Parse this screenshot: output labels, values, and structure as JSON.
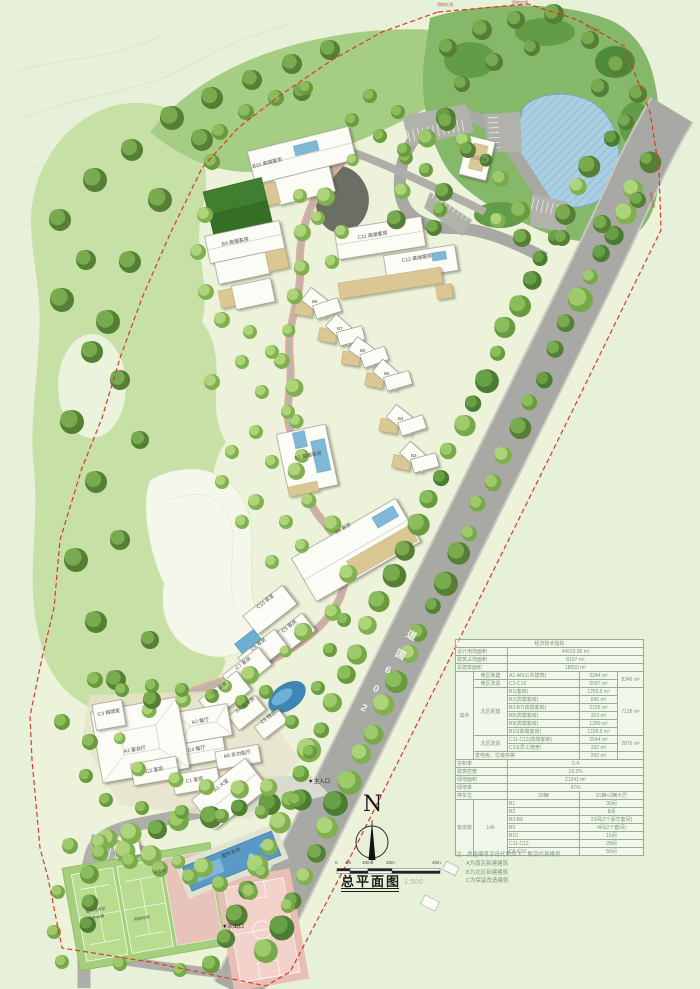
{
  "title": {
    "text": "总平面图",
    "scale": "1:500"
  },
  "compass": {
    "n": "N"
  },
  "scalebar": {
    "t0": "0",
    "t1": "4m",
    "t2": "10m",
    "t3": "20m",
    "t4": "40m"
  },
  "road": {
    "name": "206国道",
    "chars": [
      "2",
      "0",
      "6",
      "国",
      "道"
    ]
  },
  "palette": {
    "boundary_red": "#da392b",
    "water_blue": "#aacfe2",
    "road_gray": "#a8a8a4",
    "tree_green": "#77a84a",
    "building_white": "#fcfcf6",
    "terrace_tan": "#dbc794"
  },
  "labels": {
    "b10": "B10 高端客房",
    "b9": "B9 高端客房",
    "c11": "C11 高端客房",
    "c12": "C12 高端客房",
    "b8": "B8",
    "b7": "B7",
    "b6": "B6",
    "b5": "B5",
    "b4": "B4",
    "b3": "B3",
    "b2": "B2 高端客房",
    "b1": "B1 客房",
    "c10": "C10 茶室",
    "c9": "C9 客房",
    "c8": "C8 客房",
    "c7": "C7 客房",
    "c6": "C6 客房",
    "c5": "C5 精品店",
    "a4": "A4 健身房",
    "a3": "A3 餐厅",
    "c4": "C4 餐厅",
    "a2": "A2 宴会厅",
    "a6": "A6 多功能厅",
    "c3": "C3 棋牌室",
    "c2": "C2 客房",
    "c1": "C1 客房",
    "a1": "A1 大堂",
    "c13": "C13 员工宿舍",
    "pool": "室外泳池",
    "temp_parking_1": "临时停车区",
    "temp_parking_2": "可停40辆",
    "tennis": "网球场地",
    "parking": "停车场",
    "main_entrance": "▼主入口",
    "side_exit": "▼次出口",
    "boundary": "用地红线"
  },
  "table": {
    "title": "经济技术指标",
    "r1l": "设计用地面积",
    "r1v": "44919.95 m²",
    "r2l": "建筑占地面积",
    "r2v": "8197 m²",
    "r3l": "总建筑面积",
    "r3v": "18550 m²",
    "qz": "其中",
    "s1": "南区新建",
    "s1b": "A1-A6(公共建筑)",
    "s1v": "3244 m²",
    "s1t": "8346 m²",
    "s2": "南区改造",
    "s2b": "C1-C10",
    "s2v": "5097 m²",
    "s3": "北区新建",
    "n1b": "B1(客房)",
    "n1v": "1255.5 m²",
    "nt": "7128 m²",
    "n2b": "B2(高端客房)",
    "n2v": "896 m²",
    "n3b": "B3-B7(高端客房)",
    "n3v": "2155 m²",
    "n4b": "B8(高端客房)",
    "n4v": "313 m²",
    "n5b": "B9(高端客房)",
    "n5v": "1280 m²",
    "n6b": "B10(高端客房)",
    "n6v": "1228.5 m²",
    "s4": "北区改造",
    "m1b": "C11-C12(高端客房)",
    "m1v": "2544 m²",
    "mt": "2876 m²",
    "m2b": "C13(员工宿舍)",
    "m2v": "332 m²",
    "s5": "变电房、垃圾房等",
    "s5v": "200 m²",
    "r4l": "容积率",
    "r4v": "0.4",
    "r5l": "建筑密度",
    "r5v": "18.2%",
    "r6l": "绿地面积",
    "r6v": "21241 m²",
    "r7l": "绿地率",
    "r7v": "47%",
    "r8l": "停车位",
    "r8v": "93辆",
    "r8x": "91辆+2辆大巴",
    "r9l": "客房数",
    "r9v": "146",
    "k1": "B1",
    "k1v": "30间",
    "k2": "B2",
    "k2v": "8间",
    "k3": "B3-B8",
    "k3v": "22间(2个豪华套间)",
    "k4": "B9",
    "k4v": "4间(2个套间)",
    "k5": "B10",
    "k5v": "16间",
    "k6": "C11-C12",
    "k6v": "28间",
    "k7": "C6-C10",
    "k7v": "56间"
  },
  "notes": {
    "l0": "注：房屋编号字母代表如下，数字代表楼号",
    "l1": "A为南区新建建筑",
    "l2": "B为北区新建建筑",
    "l3": "C为保留改造建筑"
  }
}
